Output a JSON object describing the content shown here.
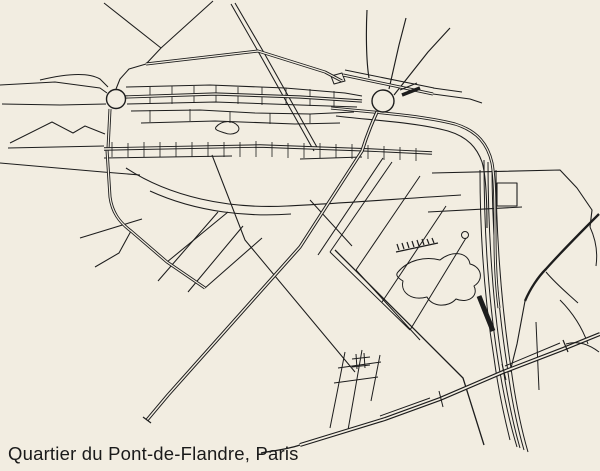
{
  "caption": {
    "text": "Quartier du Pont-de-Flandre, Paris"
  },
  "map": {
    "width": 600,
    "height": 471,
    "background": "#f2ede1",
    "line_color": "#1d1d1d",
    "caption_color": "#1a1a1a",
    "roundabouts": [
      {
        "cx": 116,
        "cy": 99,
        "r": 9.5,
        "w": 1.4
      },
      {
        "cx": 383,
        "cy": 101,
        "r": 11,
        "w": 1.4
      }
    ],
    "roads": [
      {
        "d": "M0,85 L55,82 L100,88 L107,93",
        "w": 1.05
      },
      {
        "d": "M2,104 L60,105 L106,104",
        "w": 1.05
      },
      {
        "d": "M40,80 C65,74 88,72 100,79 L108,87",
        "w": 1.05
      },
      {
        "d": "M10,143 L52,122 L73,133 L85,126 L105,134",
        "w": 1.05
      },
      {
        "d": "M8,148 L104,146",
        "w": 1.05
      },
      {
        "d": "M0,163 L103,172 L140,175",
        "w": 1.05
      },
      {
        "d": "M104,3 L161,48 L146,64 M213,1 L161,48",
        "w": 1.05
      },
      {
        "d": "M231,4 L259,53 L314,151 M235,3 L263,51 L318,149",
        "w": 1.05
      },
      {
        "d": "M116,89 L120,79 L129,69 L146,64",
        "w": 1.05
      },
      {
        "d": "M126,87 L210,85 L285,88 L345,93 L362,96",
        "w": 1.05
      },
      {
        "d": "M127,104 L215,102 L300,105 L357,107",
        "w": 1.05
      },
      {
        "d": "M131,111 L200,110 L255,113 L310,114 L354,112",
        "w": 1.05
      },
      {
        "d": "M141,123 L215,121 L295,124 L340,123",
        "w": 1.05
      },
      {
        "d": "M216,127 C222,120 233,120 238,126 C242,132 232,136 225,133 C219,131 214,130 216,127",
        "w": 1
      },
      {
        "d": "M150,87 L150,104 M172,86 L172,104 M194,86 L194,103 M216,85 L216,102 M238,87 L238,104 M262,87 L262,105 M286,88 L286,105 M310,89 L310,106 M334,91 L334,108",
        "w": 0.8
      },
      {
        "d": "M150,110 L150,122 M190,109 L190,121 M230,112 L230,123 M270,113 L270,124 M310,114 L310,123",
        "w": 0.8
      },
      {
        "d": "M80,238 L142,219",
        "w": 1.05
      },
      {
        "d": "M205,288 L262,238 M167,262 L228,212",
        "w": 1.05
      },
      {
        "d": "M218,212 L158,281 M243,226 L188,292",
        "w": 1.05
      },
      {
        "d": "M131,231 L119,253 L95,267",
        "w": 1.05
      },
      {
        "d": "M126,168 C170,197 228,209 287,206 C345,203 410,198 461,195",
        "w": 1.1
      },
      {
        "d": "M150,191 C198,213 250,217 291,214",
        "w": 1.05
      },
      {
        "d": "M104,158 L232,156 M300,159 L362,157",
        "w": 1
      },
      {
        "d": "M369,78 C366,60 366,30 367,10 M389,89 L399,45 L406,18 M394,95 L428,52 L450,28",
        "w": 1.15
      },
      {
        "d": "M345,70 L434,88",
        "w": 1.05
      },
      {
        "d": "M433,88 L462,92 M433,94 L470,99 L482,103",
        "w": 1.05
      },
      {
        "d": "M331,76 L342,73 L345,81 L334,84 Z",
        "w": 1.05
      },
      {
        "d": "M336,116 C368,120 415,122 448,131 C468,137 477,148 482,162 C486,175 487,200 487,228",
        "w": 1.1
      },
      {
        "d": "M383,158 L318,255",
        "w": 1.05
      },
      {
        "d": "M212,155 L245,240 L355,372",
        "w": 1.05
      },
      {
        "d": "M335,250 L463,378 L484,445",
        "w": 1.3
      },
      {
        "d": "M396,252 L438,243 M399,250 L397,244 M404,249 L402,243 M409,248 L407,242 M414,247 L412,241 M419,246 L417,240 M424,245 L422,239 M429,244 L427,239 M434,243 L432,238",
        "w": 1.2
      },
      {
        "d": "M398,272 C408,260 425,256 440,260 C452,250 468,252 470,264 C482,267 484,280 474,286 C479,296 468,304 456,299 C448,308 432,307 427,297 C412,301 400,293 403,281 C398,278 395,275 398,272",
        "w": 1
      },
      {
        "d": "M392,162 L330,252 M420,176 L356,270 M446,206 L382,302 M466,238 L410,330",
        "w": 1
      },
      {
        "d": "M330,252 L410,330 M356,270 L420,340 M310,200 L352,246",
        "w": 1
      },
      {
        "d": "M432,173 L560,170 L577,188 M577,188 L592,210 L590,227",
        "w": 1.1
      },
      {
        "d": "M590,227 C596,240 598,252 596,266",
        "w": 1
      },
      {
        "d": "M497,183 L517,183 L517,206 L497,206 Z",
        "w": 1.1
      },
      {
        "d": "M428,212 L522,207",
        "w": 1.05
      },
      {
        "d": "M546,272 C556,284 566,292 578,303 M560,300 C572,312 582,327 588,344",
        "w": 1
      },
      {
        "d": "M484,160 C484,215 487,290 498,360 C503,392 510,424 517,447 M488,162 C488,215 491,292 502,362 C507,394 513,424 520,448 M492,165 C492,218 496,295 507,365 C511,396 517,426 524,450 M496,170 C496,222 500,298 511,368 C515,398 521,428 528,452 M480,170 C480,220 483,290 494,358 C498,388 504,416 510,440",
        "w": 1
      },
      {
        "d": "M536,322 L539,390",
        "w": 1
      },
      {
        "d": "M345,352 L337,393 M362,350 L354,396 M380,355 L371,401 M338,368 L381,362 M334,383 L378,377 M352,359 L370,357 M352,367 L370,365 M356,354 L357,369 M364,353 L365,368 M337,393 L330,428 M354,396 L348,430",
        "w": 1
      },
      {
        "d": "M461.5,235 a3.5,3.5 0 1 0 7,0 a3.5,3.5 0 1 0 -7,0",
        "w": 1
      },
      {
        "d": "M146,64 L258,51 L325,72 L342,81",
        "w": 3
      },
      {
        "d": "M146,64 L258,51 L325,72 L342,81",
        "w": 1.2,
        "c": "bg"
      },
      {
        "d": "M125,97 L215,94 L300,97 L362,101",
        "w": 3.2
      },
      {
        "d": "M125,97 L215,94 L300,97 L362,101",
        "w": 1.3,
        "c": "bg"
      },
      {
        "d": "M110,109 L108,149",
        "w": 3
      },
      {
        "d": "M110,109 L108,149",
        "w": 1.2,
        "c": "bg"
      },
      {
        "d": "M107,150 L110,197 C112,212 119,222 131,231 L167,262 L205,288",
        "w": 3
      },
      {
        "d": "M107,150 L110,197 C112,212 119,222 131,231 L167,262 L205,288",
        "w": 1.2,
        "c": "bg"
      },
      {
        "d": "M104,149 L260,146 L370,150 L432,153",
        "w": 3.4
      },
      {
        "d": "M104,149 L260,146 L370,150 L432,153",
        "w": 1.5,
        "c": "bg"
      },
      {
        "d": "M112,142 L112,157 M128,143 L128,157 M144,142 L144,157 M160,142 L160,157 M176,142 L176,157 M192,142 L192,157 M208,142 L208,157 M224,142 L224,157 M240,142 L240,157 M256,141 L256,157 M272,142 L272,157 M288,143 L288,158 M304,143 L304,158 M320,143 L320,158 M336,144 L336,158 M352,144 L352,159 M368,145 L368,159 M384,146 L384,160 M400,147 L400,160 M416,148 L416,161",
        "w": 0.8
      },
      {
        "d": "M343,75 L433,94",
        "w": 3
      },
      {
        "d": "M343,75 L433,94",
        "w": 1.2,
        "c": "bg"
      },
      {
        "d": "M402,95 L420,88",
        "w": 3.5
      },
      {
        "d": "M400,90 L417,83",
        "w": 1.1
      },
      {
        "d": "M331,108 C370,112 420,115 455,124 C478,131 488,145 492,163 C495,180 495,205 495,235 C495,262 496,285 499,308",
        "w": 3
      },
      {
        "d": "M331,108 C370,112 420,115 455,124 C478,131 488,145 492,163 C495,180 495,205 495,235 C495,262 496,285 499,308",
        "w": 1.2,
        "c": "bg"
      },
      {
        "d": "M377,112 C371,125 366,138 362,151 L300,247 L168,395 L147,420",
        "w": 3.4
      },
      {
        "d": "M377,112 C371,125 366,138 362,151 L300,247 L168,395 L147,420",
        "w": 1.4,
        "c": "bg"
      },
      {
        "d": "M143,417 L151,423",
        "w": 1.2
      },
      {
        "d": "M479,296 L493,331",
        "w": 5
      },
      {
        "d": "M599,214 C582,231 562,251 546,269 C538,277 530,289 525,301",
        "w": 2.3
      },
      {
        "d": "M525,301 L517,344 L510,372",
        "w": 1.1
      },
      {
        "d": "M600,334 L563,349 L503,372 L440,399 L385,419 L300,445",
        "w": 4
      },
      {
        "d": "M600,334 L563,349 L503,372 L440,399 L385,419 L300,445",
        "w": 1.7,
        "c": "bg"
      },
      {
        "d": "M560,343 L505,366 M430,398 L380,416",
        "w": 1
      },
      {
        "d": "M300,445 C285,450 271,451 261,453",
        "w": 1.4
      },
      {
        "d": "M502,364 L506,380 M439,391 L443,407",
        "w": 1
      },
      {
        "d": "M563,340 L568,352",
        "w": 1.2
      },
      {
        "d": "M566,344 C578,340 590,345 599,352",
        "w": 1
      }
    ]
  }
}
